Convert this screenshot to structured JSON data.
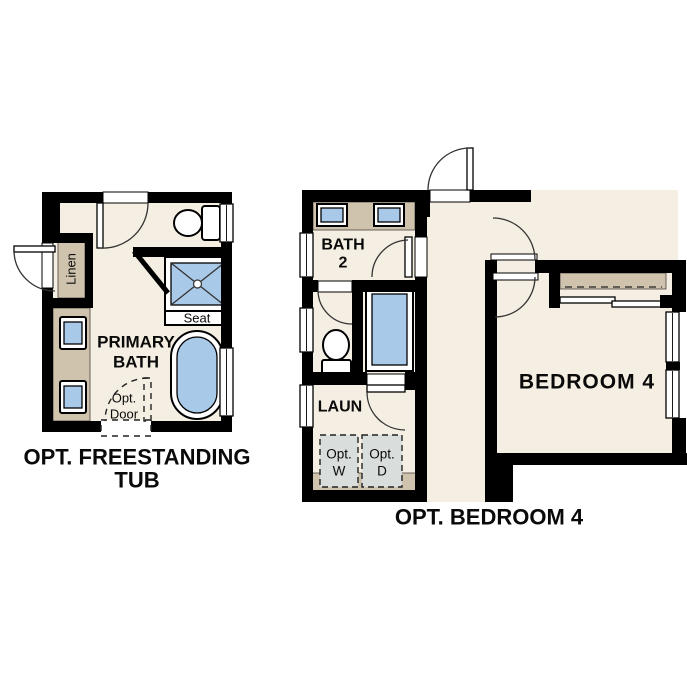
{
  "colors": {
    "floor": "#f5eee2",
    "wall": "#000000",
    "counter": "#cfc3ad",
    "fixture": "#a9c9e8",
    "appliance": "#d9dddc"
  },
  "left_plan": {
    "caption_line1": "OPT. FREESTANDING",
    "caption_line2": "TUB",
    "room_line1": "PRIMARY",
    "room_line2": "BATH",
    "linen": "Linen",
    "seat": "Seat",
    "opt_door_line1": "Opt.",
    "opt_door_line2": "Door"
  },
  "right_plan": {
    "caption": "OPT. BEDROOM 4",
    "bath_line1": "BATH",
    "bath_line2": "2",
    "laundry": "LAUN",
    "washer_line1": "Opt.",
    "washer_line2": "W",
    "dryer_line1": "Opt.",
    "dryer_line2": "D",
    "bedroom": "BEDROOM 4"
  }
}
